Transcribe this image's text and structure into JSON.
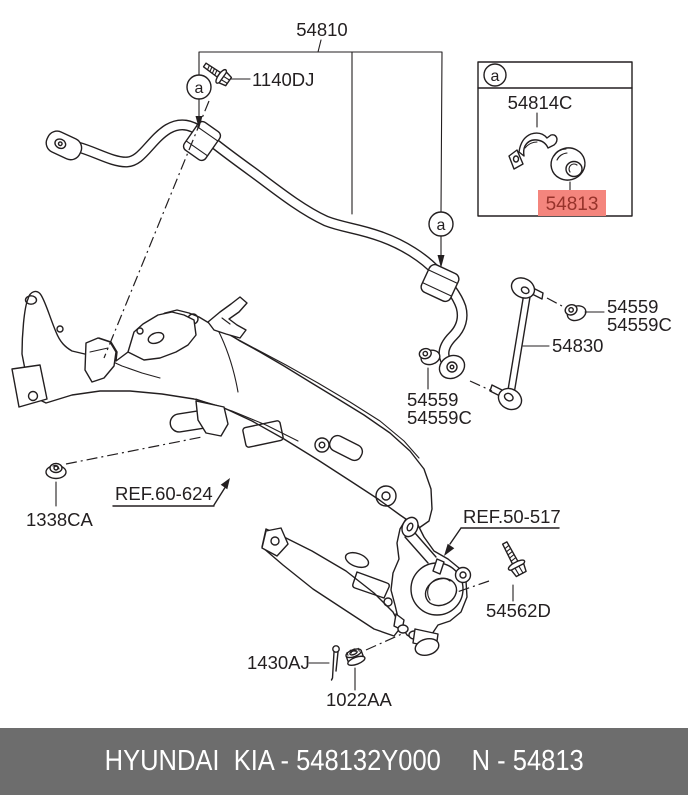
{
  "canvas": {
    "width": 688,
    "height": 795
  },
  "colors": {
    "background": "#ffffff",
    "line": "#231f20",
    "highlight_bg": "#f4857d",
    "highlight_text": "#97332b",
    "footer_bg": "#6d6d6d",
    "footer_text": "#ffffff"
  },
  "detail_marker": "a",
  "callouts": {
    "stabilizer_bar": "54810",
    "clamp_bolt": "1140DJ",
    "clamp_bracket": "54814C",
    "stabilizer_bushing": "54813",
    "link_nut_upper": "54559",
    "link_nut_upper_c": "54559C",
    "stabilizer_link": "54830",
    "link_nut_lower": "54559",
    "link_nut_lower_c": "54559C",
    "mounting_nut": "1338CA",
    "crossmember_ref": "REF.60-624",
    "lower_arm_ref": "REF.50-517",
    "knuckle_bolt": "54562D",
    "cotter_pin": "1430AJ",
    "castle_nut": "1022AA"
  },
  "footer": {
    "left": "HYUNDAI  KIA - 548132Y000",
    "right": "N - 54813"
  }
}
